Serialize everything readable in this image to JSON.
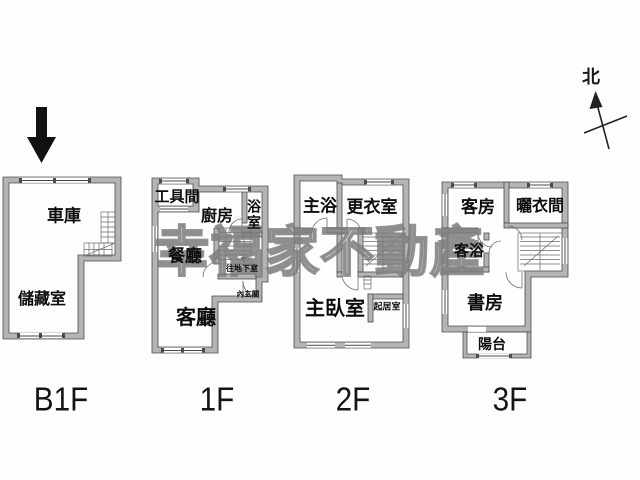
{
  "watermark": {
    "text": "幸福家不動產"
  },
  "compass": {
    "label": "北"
  },
  "colors": {
    "wall_fill": "#b4b4b4",
    "wall_outline": "#4c4c4c",
    "watermark_gray": "#9a9a9a",
    "entrance_arrow": "#111111"
  },
  "floors": [
    {
      "id": "b1f",
      "label": "B1F",
      "rooms": [
        {
          "name": "車庫"
        },
        {
          "name": "儲藏室"
        }
      ]
    },
    {
      "id": "1f",
      "label": "1F",
      "rooms": [
        {
          "name": "工具間"
        },
        {
          "name": "廚房"
        },
        {
          "name": "浴室"
        },
        {
          "name": "餐廳"
        },
        {
          "name": "客廳"
        },
        {
          "name": "往地下室"
        },
        {
          "name": "內玄關"
        }
      ]
    },
    {
      "id": "2f",
      "label": "2F",
      "rooms": [
        {
          "name": "主浴"
        },
        {
          "name": "更衣室"
        },
        {
          "name": "主臥室"
        },
        {
          "name": "起居室"
        }
      ]
    },
    {
      "id": "3f",
      "label": "3F",
      "rooms": [
        {
          "name": "客房"
        },
        {
          "name": "曬衣間"
        },
        {
          "name": "客浴"
        },
        {
          "name": "書房"
        },
        {
          "name": "陽台"
        }
      ]
    }
  ]
}
